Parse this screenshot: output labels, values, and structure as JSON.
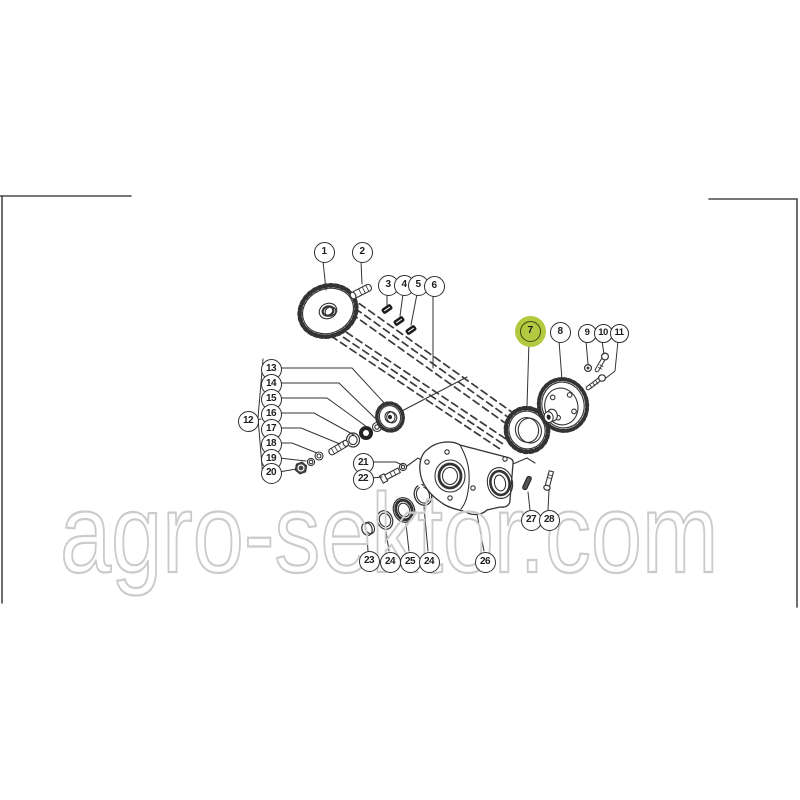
{
  "watermark": {
    "text": "agro-sektor.com",
    "stroke_color": "#cbcbcb"
  },
  "highlight": {
    "color": "#b3c93f",
    "highlighted_callout": "7"
  },
  "callouts": {
    "items": [
      {
        "label": "1"
      },
      {
        "label": "2"
      },
      {
        "label": "3"
      },
      {
        "label": "4"
      },
      {
        "label": "5"
      },
      {
        "label": "6"
      },
      {
        "label": "7"
      },
      {
        "label": "8"
      },
      {
        "label": "9"
      },
      {
        "label": "10"
      },
      {
        "label": "11"
      },
      {
        "label": "12"
      },
      {
        "label": "13"
      },
      {
        "label": "14"
      },
      {
        "label": "15"
      },
      {
        "label": "16"
      },
      {
        "label": "17"
      },
      {
        "label": "18"
      },
      {
        "label": "19"
      },
      {
        "label": "20"
      },
      {
        "label": "21"
      },
      {
        "label": "22"
      },
      {
        "label": "23"
      },
      {
        "label": "24"
      },
      {
        "label": "25"
      },
      {
        "label": "24"
      },
      {
        "label": "26"
      },
      {
        "label": "27"
      },
      {
        "label": "28"
      }
    ]
  }
}
